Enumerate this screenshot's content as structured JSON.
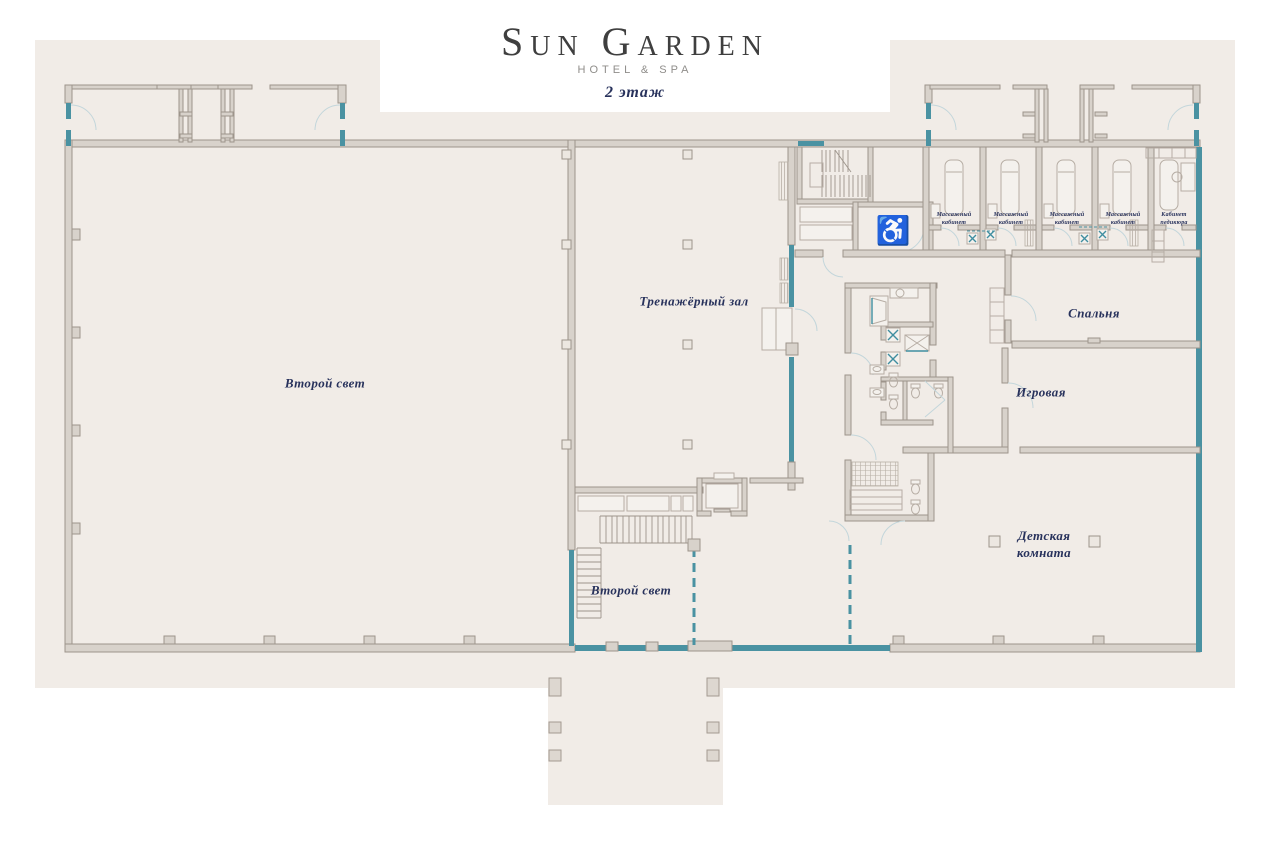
{
  "header": {
    "brand": "Sun Garden",
    "tagline": "HOTEL & SPA",
    "floor_label": "2 этаж"
  },
  "rooms": {
    "second_light_main": "Второй свет",
    "gym": "Тренажёрный зал",
    "bedroom": "Спальня",
    "playroom": "Игровая",
    "kids_room": "Детская комната",
    "second_light_lower": "Второй свет",
    "massage": "Массажный кабинет",
    "pedicure": "Кабинет педикюра"
  },
  "icons": {
    "wheelchair": "♿"
  },
  "colors": {
    "plan_background": "#f1ece7",
    "wall": "#9d948b",
    "glazing_teal": "#4a92a2",
    "label_navy": "#28325c",
    "brand_dark": "#3f3f3f",
    "brand_gray": "#8f8d8a"
  }
}
